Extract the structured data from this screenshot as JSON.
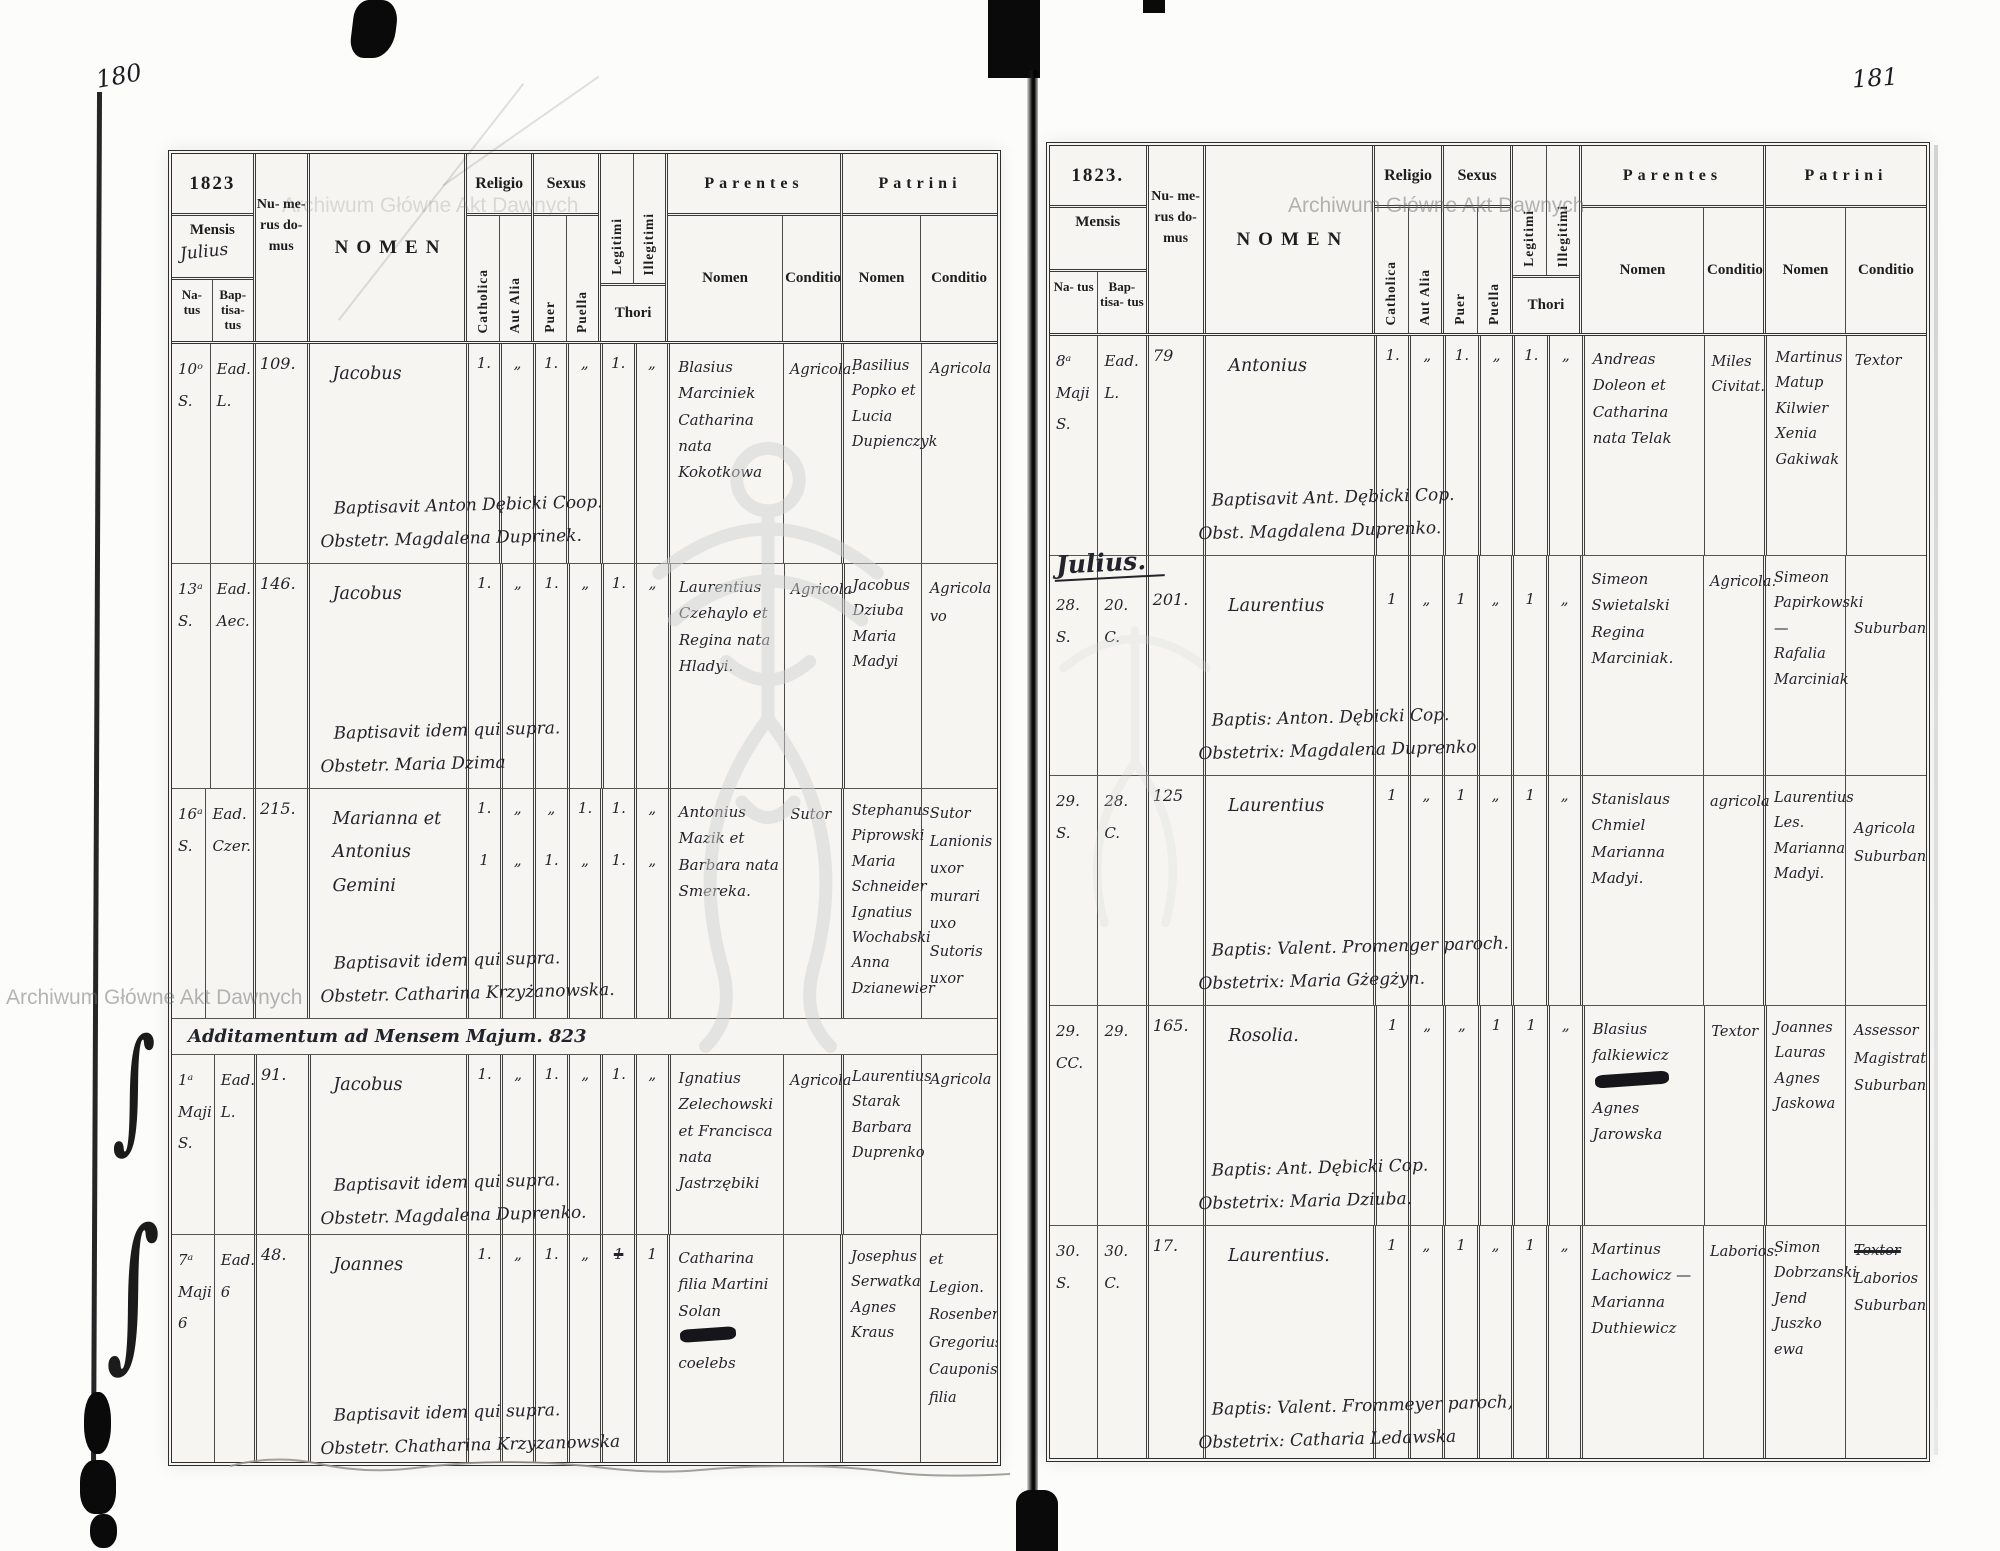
{
  "page_numbers": {
    "left": "180",
    "right": "181"
  },
  "watermark": {
    "text": "Archiwum Główne Akt Dawnych"
  },
  "decorations": {
    "brace": "∫"
  },
  "labels": {
    "year_left": "1823",
    "year_right": "1823.",
    "mensis": "Mensis",
    "natus": "Na- tus",
    "baptisatus": "Bap- tisa- tus",
    "numerus": "Nu- me- rus do- mus",
    "nomen": "NOMEN",
    "religio": "Religio",
    "catholica": "Catholica",
    "aut_alia": "Aut Alia",
    "sexus": "Sexus",
    "puer": "Puer",
    "puella": "Puella",
    "legitimi": "Legitimi",
    "illegitimi": "Illegitimi",
    "thori": "Thori",
    "parentes": "Parentes",
    "patrini": "Patrini",
    "nomen_sub": "Nomen",
    "conditio": "Conditio"
  },
  "left": {
    "month": "Julius",
    "section_heading": "Additamentum ad Mensem Majum. 823",
    "rows": [
      {
        "nat1": "10ᵒ",
        "nat2": "S.",
        "bap1": "Ead.",
        "bap2": "L.",
        "num": "109.",
        "nomen": "Jacobus",
        "marks": [
          "1.",
          "„",
          "1.",
          "„",
          "1.",
          "„"
        ],
        "pn": "Blasius Marciniek Catharina nata Kokotkowa",
        "pc": "Agricola.",
        "ptn": "Basilius Popko et Lucia Dupienczyk",
        "ptc": "Agricola",
        "note1": "Baptisavit Anton Dębicki Coop.",
        "note2": "Obstetr. Magdalena Duprinek."
      },
      {
        "nat1": "13ᵃ",
        "nat2": "S.",
        "bap1": "Ead.",
        "bap2": "Aec.",
        "num": "146.",
        "nomen": "Jacobus",
        "marks": [
          "1.",
          "„",
          "1.",
          "„",
          "1.",
          "„"
        ],
        "pn": "Laurentius Czehaylo et Regina nata Hladyi.",
        "pc": "Agricola",
        "ptn": "Jacobus Dziuba Maria Madyi",
        "ptc": "Agricola vo",
        "note1": "Baptisavit idem qui supra.",
        "note2": "Obstetr. Maria Dzima"
      },
      {
        "nat1": "16ᵃ",
        "nat2": "S.",
        "bap1": "Ead.",
        "bap2": "Czer.",
        "num": "215.",
        "nomen": "Marianna et Antonius Gemini",
        "marks": [
          "1.",
          "„",
          "„",
          "1.",
          "1.",
          "„"
        ],
        "marks2": [
          "1",
          "„",
          "1.",
          "„",
          "1.",
          "„"
        ],
        "pn": "Antonius Mazik et Barbara nata Smereka.",
        "pc": "Sutor",
        "ptn": "Stephanus Piprowski Maria Schneider Ignatius Wochabski Anna Dzianewier",
        "ptc": "Sutor Lanionis uxor murari uxo Sutoris uxor",
        "note1": "Baptisavit idem qui supra.",
        "note2": "Obstetr. Catharina Krzyżanowska."
      },
      {
        "nat1": "1ᵃ",
        "nat2": "Maji",
        "nat3": "S.",
        "bap1": "Ead.",
        "bap3": "L.",
        "num": "91.",
        "nomen": "Jacobus",
        "marks": [
          "1.",
          "„",
          "1.",
          "„",
          "1.",
          "„"
        ],
        "pn": "Ignatius Zelechowski et Francisca nata Jastrzębiki",
        "pc": "Agricola",
        "ptn": "Laurentius Starak Barbara Duprenko",
        "ptc": "Agricola",
        "note1": "Baptisavit idem qui supra.",
        "note2": "Obstetr. Magdalena Duprenko."
      },
      {
        "nat1": "7ᵃ",
        "nat2": "Maji",
        "nat3": "6",
        "bap1": "Ead.",
        "bap3": "6",
        "num": "48.",
        "nomen": "Joannes",
        "marks": [
          "1.",
          "„",
          "1.",
          "„",
          "1",
          "1"
        ],
        "pn": "Catharina filia Martini Solan",
        "pn2": "coelebs",
        "ptn": "Josephus Serwatka Agnes Kraus",
        "ptc": "et Legion. Rosenberg Gregorius Cauponis filia",
        "note1": "Baptisavit idem qui supra.",
        "note2": "Obstetr. Chatharina Krzyzanowska"
      }
    ]
  },
  "right": {
    "month_heading": "Julius.",
    "rows": [
      {
        "nat1": "8ᵃ",
        "nat2": "Maji",
        "nat3": "S.",
        "bap1": "Ead.",
        "bap3": "L.",
        "num": "79",
        "nomen": "Antonius",
        "marks": [
          "1.",
          "„",
          "1.",
          "„",
          "1.",
          "„"
        ],
        "pn": "Andreas Doleon et Catharina nata Telak",
        "pc": "Miles Civitat.",
        "ptn": "Martinus Matup Kilwier Xenia Gakiwak",
        "ptc": "Textor",
        "note1": "Baptisavit Ant. Dębicki Cop.",
        "note2": "Obst. Magdalena Duprenko."
      },
      {
        "nat1": "28.",
        "nat2": "S.",
        "bap1": "20.",
        "bap2": "C.",
        "num": "201.",
        "nomen": "Laurentius",
        "marks": [
          "1",
          "„",
          "1",
          "„",
          "1",
          "„"
        ],
        "pn": "Simeon Swietalski Regina Marciniak.",
        "pc": "Agricola.",
        "ptn": "Simeon Papirkowski — Rafalia Marciniak",
        "ptc": "Suburbana",
        "note1": "Baptis: Anton. Dębicki Cop.",
        "note2": "Obstetrix: Magdalena Duprenko"
      },
      {
        "nat1": "29.",
        "nat2": "S.",
        "bap1": "28.",
        "bap2": "C.",
        "num": "125",
        "nomen": "Laurentius",
        "marks": [
          "1",
          "„",
          "1",
          "„",
          "1",
          "„"
        ],
        "pn": "Stanislaus Chmiel Marianna Madyi.",
        "pc": "agricola",
        "ptn": "Laurentius Les. Marianna Madyi.",
        "ptc": "Agricola Suburbani.",
        "note1": "Baptis: Valent. Promenger paroch.",
        "note2": "Obstetrix: Maria Gżegżyn."
      },
      {
        "nat1": "29.",
        "nat2": "CC.",
        "bap1": "29.",
        "num": "165.",
        "nomen": "Rosolia.",
        "marks": [
          "1",
          "„",
          "„",
          "1",
          "1",
          "„"
        ],
        "pn": "Blasius falkiewicz",
        "pn2": "Agnes Jarowska",
        "pc": "Textor",
        "ptn": "Joannes Lauras Agnes Jaskowa",
        "ptc": "Assessor Magistratual Suburban.",
        "note1": "Baptis: Ant. Dębicki Cop.",
        "note2": "Obstetrix: Maria Dziuba."
      },
      {
        "nat1": "30.",
        "nat2": "S.",
        "bap1": "30.",
        "bap2": "C.",
        "num": "17.",
        "nomen": "Laurentius.",
        "marks": [
          "1",
          "„",
          "1",
          "„",
          "1",
          "„"
        ],
        "pn": "Martinus Lachowicz — Marianna Duthiewicz",
        "pc": "Laborios.",
        "ptn": "Simon Dobrzanski Jend Juszko ewa",
        "ptc1": "Textor",
        "ptc2": "Laborios Suburban.",
        "note1": "Baptis: Valent. Frommeyer paroch,",
        "note2": "Obstetrix: Catharia Ledawska"
      }
    ]
  }
}
